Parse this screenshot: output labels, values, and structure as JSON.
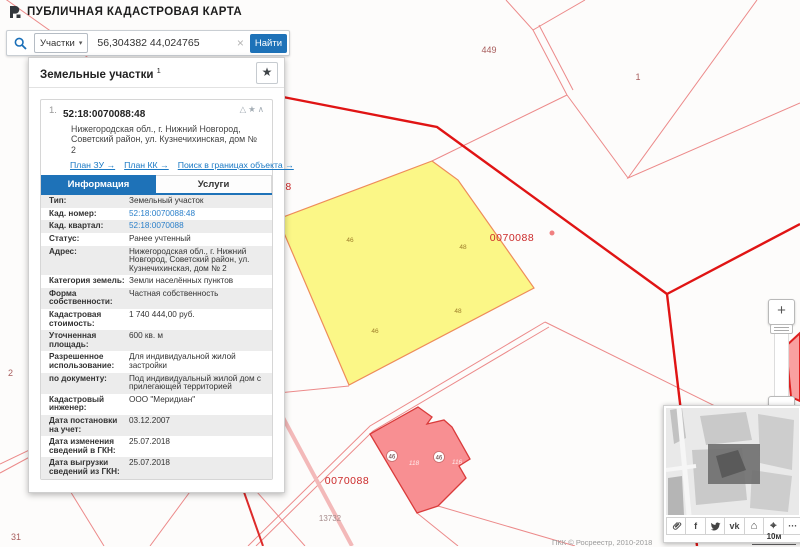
{
  "app": {
    "title": "ПУБЛИЧНАЯ КАДАСТРОВАЯ КАРТА"
  },
  "search": {
    "category_label": "Участки",
    "caret": "▾",
    "value": "56,304382 44,024765",
    "clear_glyph": "×",
    "submit_label": "Найти"
  },
  "panel": {
    "title": "Земельные участки",
    "count": "1",
    "star_glyph": "★"
  },
  "result": {
    "index": "1.",
    "cad_number": "52:18:0070088:48",
    "address": "Нижегородская обл., г. Нижний Новгород, Советский район, ул. Кузнечихинская, дом № 2",
    "header_icons": {
      "warning": "△",
      "favorite": "★",
      "collapse": "∧"
    },
    "links": {
      "plan_zu": "План ЗУ →",
      "plan_kk": "План КК →",
      "search_within": "Поиск в границах объекта →"
    },
    "tabs": {
      "info": "Информация",
      "services": "Услуги"
    }
  },
  "info_rows": [
    {
      "label": "Тип:",
      "value": "Земельный участок",
      "type": "text"
    },
    {
      "label": "Кад. номер:",
      "value": "52:18:0070088:48",
      "type": "link"
    },
    {
      "label": "Кад. квартал:",
      "value": "52:18:0070088",
      "type": "link"
    },
    {
      "label": "Статус:",
      "value": "Ранее учтенный",
      "type": "text"
    },
    {
      "label": "Адрес:",
      "value": "Нижегородская обл., г. Нижний Новгород, Советский район, ул. Кузнечихинская, дом № 2",
      "type": "text"
    },
    {
      "label": "Категория земель:",
      "value": "Земли населённых пунктов",
      "type": "text"
    },
    {
      "label": "Форма собственности:",
      "value": "Частная собственность",
      "type": "text"
    },
    {
      "label": "Кадастровая стоимость:",
      "value": "1 740 444,00 руб.",
      "type": "text"
    },
    {
      "label": "Уточненная площадь:",
      "value": "600 кв. м",
      "type": "text"
    },
    {
      "label": "Разрешенное использование:",
      "value": "Для индивидуальной жилой застройки",
      "type": "text"
    },
    {
      "label": "по документу:",
      "value": "Под индивидуальный жилой дом с прилегающей территорией",
      "type": "text"
    },
    {
      "label": "Кадастровый инженер:",
      "value": "ООО \"Меридиан\"",
      "type": "text"
    },
    {
      "label": "Дата постановки на учет:",
      "value": "03.12.2007",
      "type": "text"
    },
    {
      "label": "Дата изменения сведений в ГКН:",
      "value": "25.07.2018",
      "type": "text"
    },
    {
      "label": "Дата выгрузки сведений из ГКН:",
      "value": "25.07.2018",
      "type": "text"
    }
  ],
  "map": {
    "labels": [
      {
        "text": "449",
        "kind": "parcel-number"
      },
      {
        "text": "1",
        "kind": "parcel-number"
      },
      {
        "text": "88",
        "kind": "quarter-number-clipped"
      },
      {
        "text": "0070088",
        "kind": "quarter-number"
      },
      {
        "text": "0070088",
        "kind": "quarter-number"
      },
      {
        "text": "46",
        "kind": "point-number"
      },
      {
        "text": "48",
        "kind": "point-number"
      },
      {
        "text": "48",
        "kind": "point-number"
      },
      {
        "text": "46",
        "kind": "point-number"
      },
      {
        "text": "46",
        "kind": "building-badge"
      },
      {
        "text": "118",
        "kind": "building-number"
      },
      {
        "text": "46",
        "kind": "building-badge"
      },
      {
        "text": "116",
        "kind": "building-number"
      },
      {
        "text": "30",
        "kind": "parcel-number"
      },
      {
        "text": "31",
        "kind": "parcel-number"
      },
      {
        "text": "13732",
        "kind": "parcel-number"
      },
      {
        "text": "2",
        "kind": "parcel-number"
      }
    ],
    "selected_parcel_fill": "#fbf67d",
    "building_fill": "#f88f92",
    "boundary_color": "#e01414",
    "parcel_line_color": "#ec8a8a"
  },
  "zoom_control": {
    "zoom_in": "+",
    "zoom_out": "−"
  },
  "minimap": {
    "scale_label": "10м",
    "attribution": "ПКК © Росреестр, 2010-2018",
    "toolbar": [
      {
        "name": "link-icon",
        "glyph": ""
      },
      {
        "name": "facebook-icon",
        "glyph": "f"
      },
      {
        "name": "twitter-icon",
        "glyph": ""
      },
      {
        "name": "vk-icon",
        "glyph": "vk"
      },
      {
        "name": "home-icon",
        "glyph": "⌂"
      },
      {
        "name": "locate-icon",
        "glyph": "⌖"
      },
      {
        "name": "more-icon",
        "glyph": "···"
      }
    ]
  }
}
